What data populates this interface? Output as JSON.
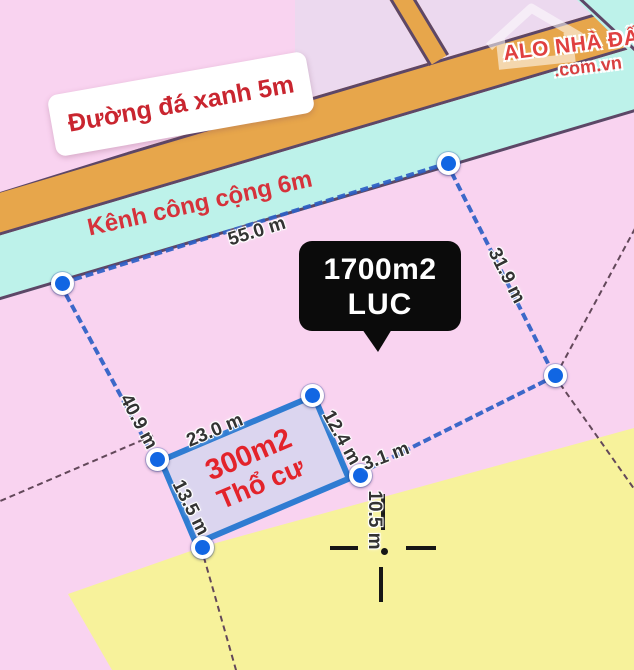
{
  "watermark": {
    "brand": "ALO NHÀ ĐẤT",
    "domain": ".com.vn"
  },
  "labels": {
    "road": "Đường đá xanh 5m",
    "canal": "Kênh công cộng 6m"
  },
  "parcel_main": {
    "area": "1700m2",
    "land_type": "LUC",
    "edge_top": "55.0 m",
    "edge_right": "31.9 m",
    "edge_left": "40.9 m",
    "edge_connector": "3.1 m",
    "depth_marker": "10.5 m"
  },
  "parcel_inner": {
    "area": "300m2",
    "land_type": "Thổ cư",
    "edge_top": "23.0 m",
    "edge_right": "12.4 m",
    "edge_left": "13.5 m"
  },
  "colors": {
    "background_pink": "#f9d3f0",
    "adjacent_lavender": "#ecd9ef",
    "road_orange": "#e7a64b",
    "canal_cyan": "#bdf2ea",
    "neighbor_yellow": "#f7f29b",
    "inner_parcel_fill": "#dbd5ef",
    "boundary_blue": "#2d5fc6",
    "inner_border_blue": "#2f7cd2",
    "cadastral_line": "#63485a",
    "callout_bg": "#0b0b0b",
    "label_red": "#d6323b"
  }
}
